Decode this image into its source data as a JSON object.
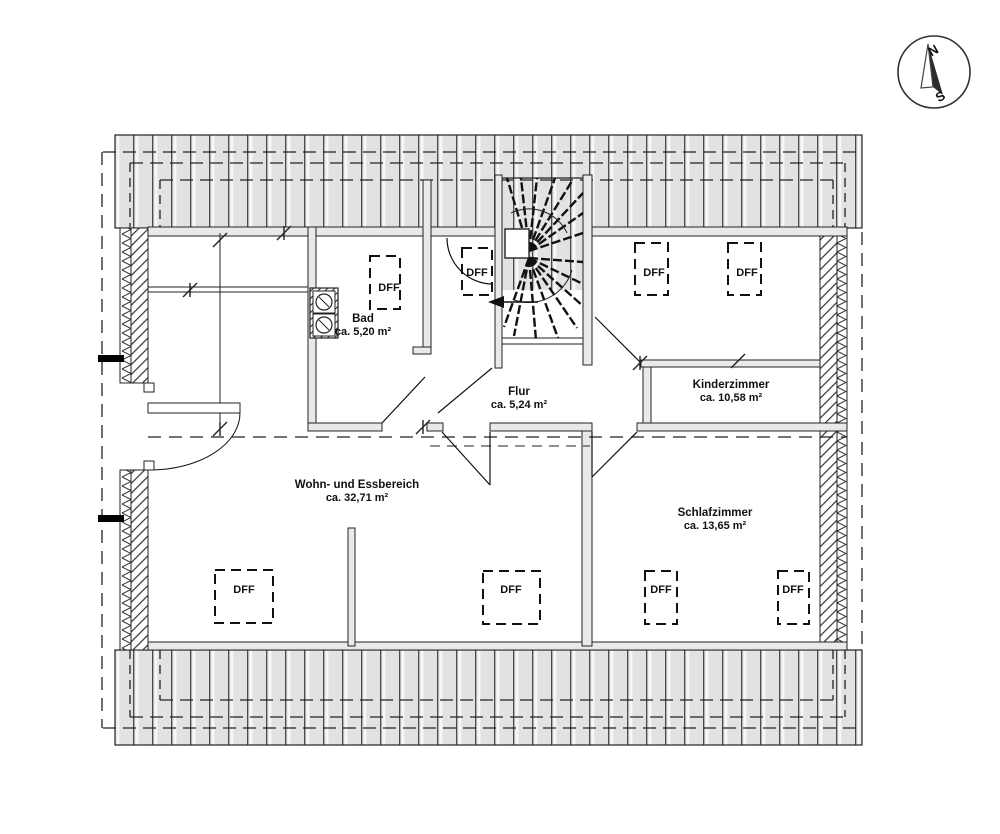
{
  "drawing": {
    "type": "floor-plan",
    "skylight_label": "DFF",
    "compass": {
      "north": "N",
      "south": "S"
    },
    "rooms": [
      {
        "name": "Bad",
        "area": "ca. 5,20 m²"
      },
      {
        "name": "Flur",
        "area": "ca. 5,24 m²"
      },
      {
        "name": "Kinderzimmer",
        "area": "ca. 10,58 m²"
      },
      {
        "name": "Wohn- und Essbereich",
        "area": "ca. 32,71 m²"
      },
      {
        "name": "Schlafzimmer",
        "area": "ca. 13,65 m²"
      }
    ],
    "colors": {
      "roof_fill": "#e2e2e2",
      "wall_fill": "#e9e9e9",
      "line": "#1a1a1a"
    }
  }
}
